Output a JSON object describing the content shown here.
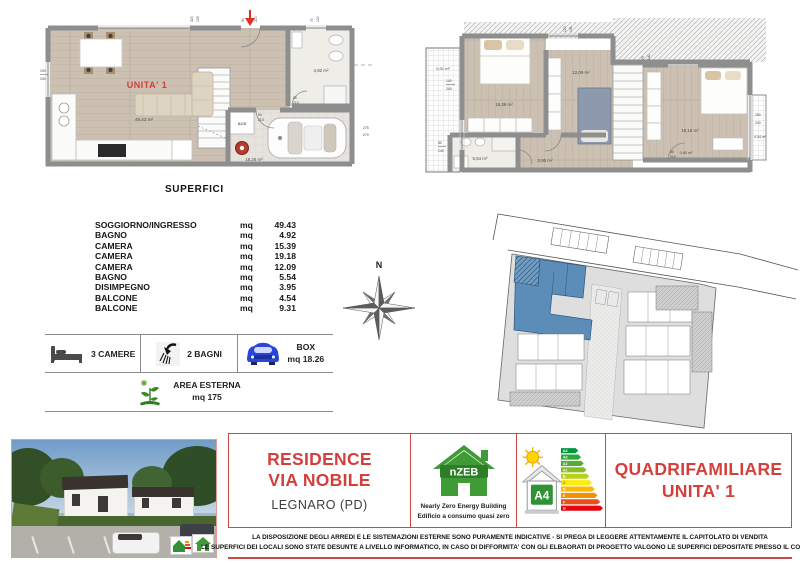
{
  "plans": {
    "ground": {
      "unit_label": "UNITA' 1",
      "soggiorno_area": "49,43 m²",
      "bagno_area": "4,92 m²",
      "box_area": "18,26 m²",
      "acs_label": "ACS",
      "dims": [
        [
          "320",
          "125"
        ],
        [
          "90",
          "210"
        ],
        [
          "70",
          "120"
        ],
        [
          "190",
          "240"
        ],
        [
          "80",
          "210"
        ],
        [
          "90",
          "210"
        ],
        [
          "275",
          "270"
        ]
      ]
    },
    "first": {
      "balcone1_area": "9,31 m²",
      "camera1_area": "15,39 m²",
      "camera2_area": "12,09 m²",
      "camera3_area": "19,18 m²",
      "bagno_area": "5,54 m²",
      "disimpegno_area": "3,95 m²",
      "ripostiglio_area": "0,80 m²",
      "balcone2_area": "4,54 m²",
      "dims": [
        [
          "120",
          "140"
        ],
        [
          "75",
          "140"
        ],
        [
          "140",
          "240"
        ],
        [
          "80",
          "140"
        ],
        [
          "150",
          "240"
        ],
        [
          "80",
          "210"
        ]
      ]
    }
  },
  "superfici": {
    "title": "SUPERFICI",
    "unit_label": "mq",
    "rows": [
      {
        "label": "SOGGIORNO/INGRESSO",
        "value": "49.43"
      },
      {
        "label": "BAGNO",
        "value": "4.92"
      },
      {
        "label": "CAMERA",
        "value": "15.39"
      },
      {
        "label": "CAMERA",
        "value": "19.18"
      },
      {
        "label": "CAMERA",
        "value": "12.09"
      },
      {
        "label": "BAGNO",
        "value": "5.54"
      },
      {
        "label": "DISIMPEGNO",
        "value": "3.95"
      },
      {
        "label": "BALCONE",
        "value": "4.54"
      },
      {
        "label": "BALCONE",
        "value": "9.31"
      }
    ]
  },
  "compass": {
    "north_label": "N"
  },
  "features": {
    "camere_label": "3 CAMERE",
    "bagni_label": "2 BAGNI",
    "box_label": "BOX",
    "box_value": "mq 18.26",
    "area_esterna_label": "AREA ESTERNA",
    "area_esterna_value": "mq 175"
  },
  "banner": {
    "residence_line1": "RESIDENCE",
    "residence_line2": "VIA NOBILE",
    "city": "LEGNARO (PD)",
    "nzeb": {
      "logo_text": "nZEB",
      "caption1": "Nearly Zero Energy Building",
      "caption2": "Edificio a consumo quasi zero"
    },
    "energy": {
      "class_label": "A4",
      "bars": [
        "A4",
        "A3",
        "A2",
        "A1",
        "B",
        "C",
        "D",
        "E",
        "F",
        "G"
      ]
    },
    "unit_line1": "QUADRIFAMILIARE",
    "unit_line2": "UNITA' 1"
  },
  "disclaimer": {
    "line1": "LA DISPOSIZIONE DEGLI ARREDI E LE SISTEMAZIONI ESTERNE SONO PURAMENTE INDICATIVE - SI PREGA DI LEGGERE ATTENTAMENTE IL CAPITOLATO DI VENDITA",
    "line2": "LE SUPERFICI DEI LOCALI SONO STATE DESUNTE A LIVELLO INFORMATICO, IN CASO DI DIFFORMITA' CON GLI ELBAORATI DI PROGETTO VALGONO LE SUPERFICI DEPOSITATE PRESSO IL COMUNE"
  },
  "colors": {
    "accent_red": "#d43f3c",
    "wall_gray": "#8e8e8e",
    "wood_floor": "#cbc0b2",
    "site_highlight_blue": "#5b8db8",
    "nzeb_green": "#3f9b36",
    "box_car_blue": "#2946d8"
  }
}
